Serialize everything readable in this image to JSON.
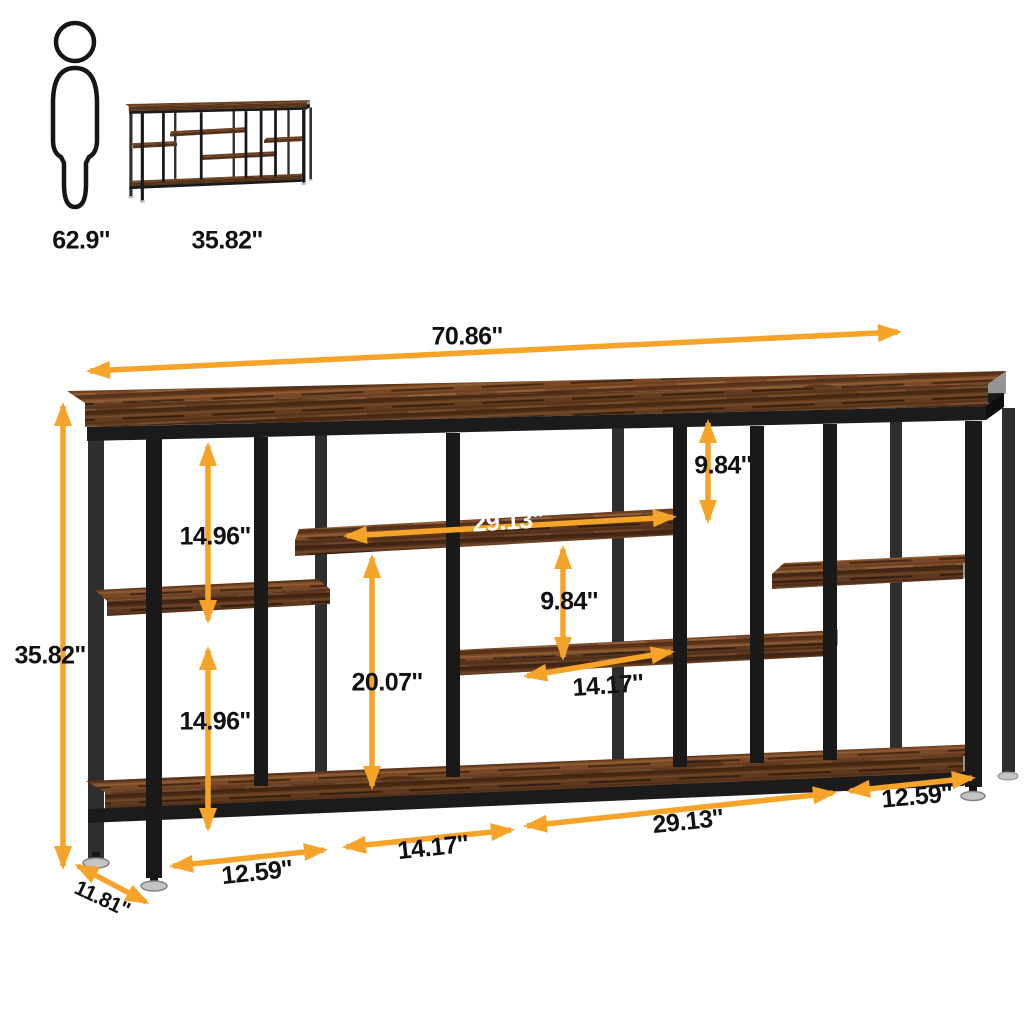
{
  "reference": {
    "person_height": "62.9''",
    "product_height": "35.82''"
  },
  "dimensions": {
    "overall_width": "70.86''",
    "overall_height": "35.82''",
    "depth": "11.81''",
    "left_upper_opening": "14.96''",
    "left_lower_opening": "14.96''",
    "middle_shelf_length": "29.13''",
    "right_upper_opening": "9.84''",
    "center_opening": "9.84''",
    "center_column_height": "20.07''",
    "lower_middle_shelf_length": "14.17''",
    "bottom_left_section": "12.59''",
    "bottom_mid_section": "14.17''",
    "bottom_long_section": "29.13''",
    "bottom_right_section": "12.59''"
  },
  "colors": {
    "arrow": "#F5A329",
    "label_text": "#111111",
    "label_text_on_wood": "#FFFFFF",
    "metal_frame": "#1B1B1B",
    "wood": "#7A4A28",
    "background": "#FFFFFF"
  }
}
